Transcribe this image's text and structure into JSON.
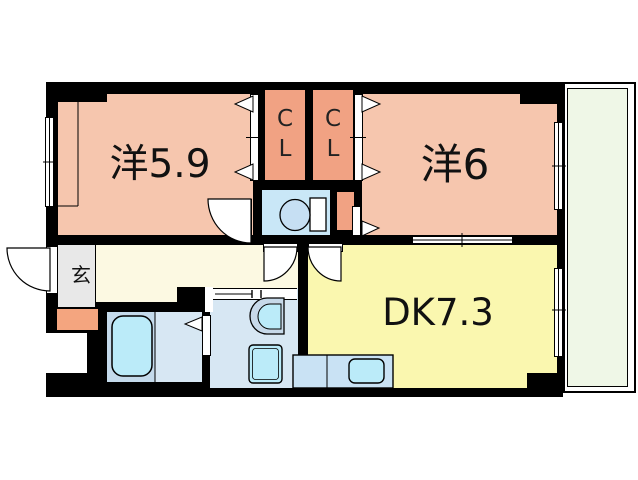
{
  "floorplan": {
    "title": "2DK apartment floor plan",
    "rooms": {
      "western_room_1": {
        "label": "洋5.9"
      },
      "western_room_2": {
        "label": "洋6"
      },
      "dining_kitchen": {
        "label": "DK7.3"
      },
      "closet_left": {
        "letter_top": "C",
        "letter_bottom": "L"
      },
      "closet_right": {
        "letter_top": "C",
        "letter_bottom": "L"
      },
      "entrance": {
        "label": "玄"
      }
    },
    "fixtures": [
      "toilet-icon",
      "bathtub-icon",
      "washbasin-icon",
      "washing-machine-pan-icon",
      "kitchen-sink-icon",
      "kitchen-counter",
      "door-swing-arc",
      "folding-door-triangle",
      "sliding-window"
    ],
    "colors": {
      "room_salmon": "#F6C6AE",
      "closet_salmon": "#F1A283",
      "porch_orange": "#F4A57F",
      "dk_yellow": "#FAF7AF",
      "hall_cream": "#FCF9E2",
      "entrance_gray": "#E8E8E8",
      "toilet_room_blue": "#C9E7F7",
      "washroom_blue": "#D7E7F3",
      "bath_platform_blue": "#C4DAEB",
      "water_cyan": "#BBEBF9",
      "counter_blue": "#C9E2F4",
      "balcony_green": "#EFF7E7",
      "wall_black": "#000000"
    }
  }
}
